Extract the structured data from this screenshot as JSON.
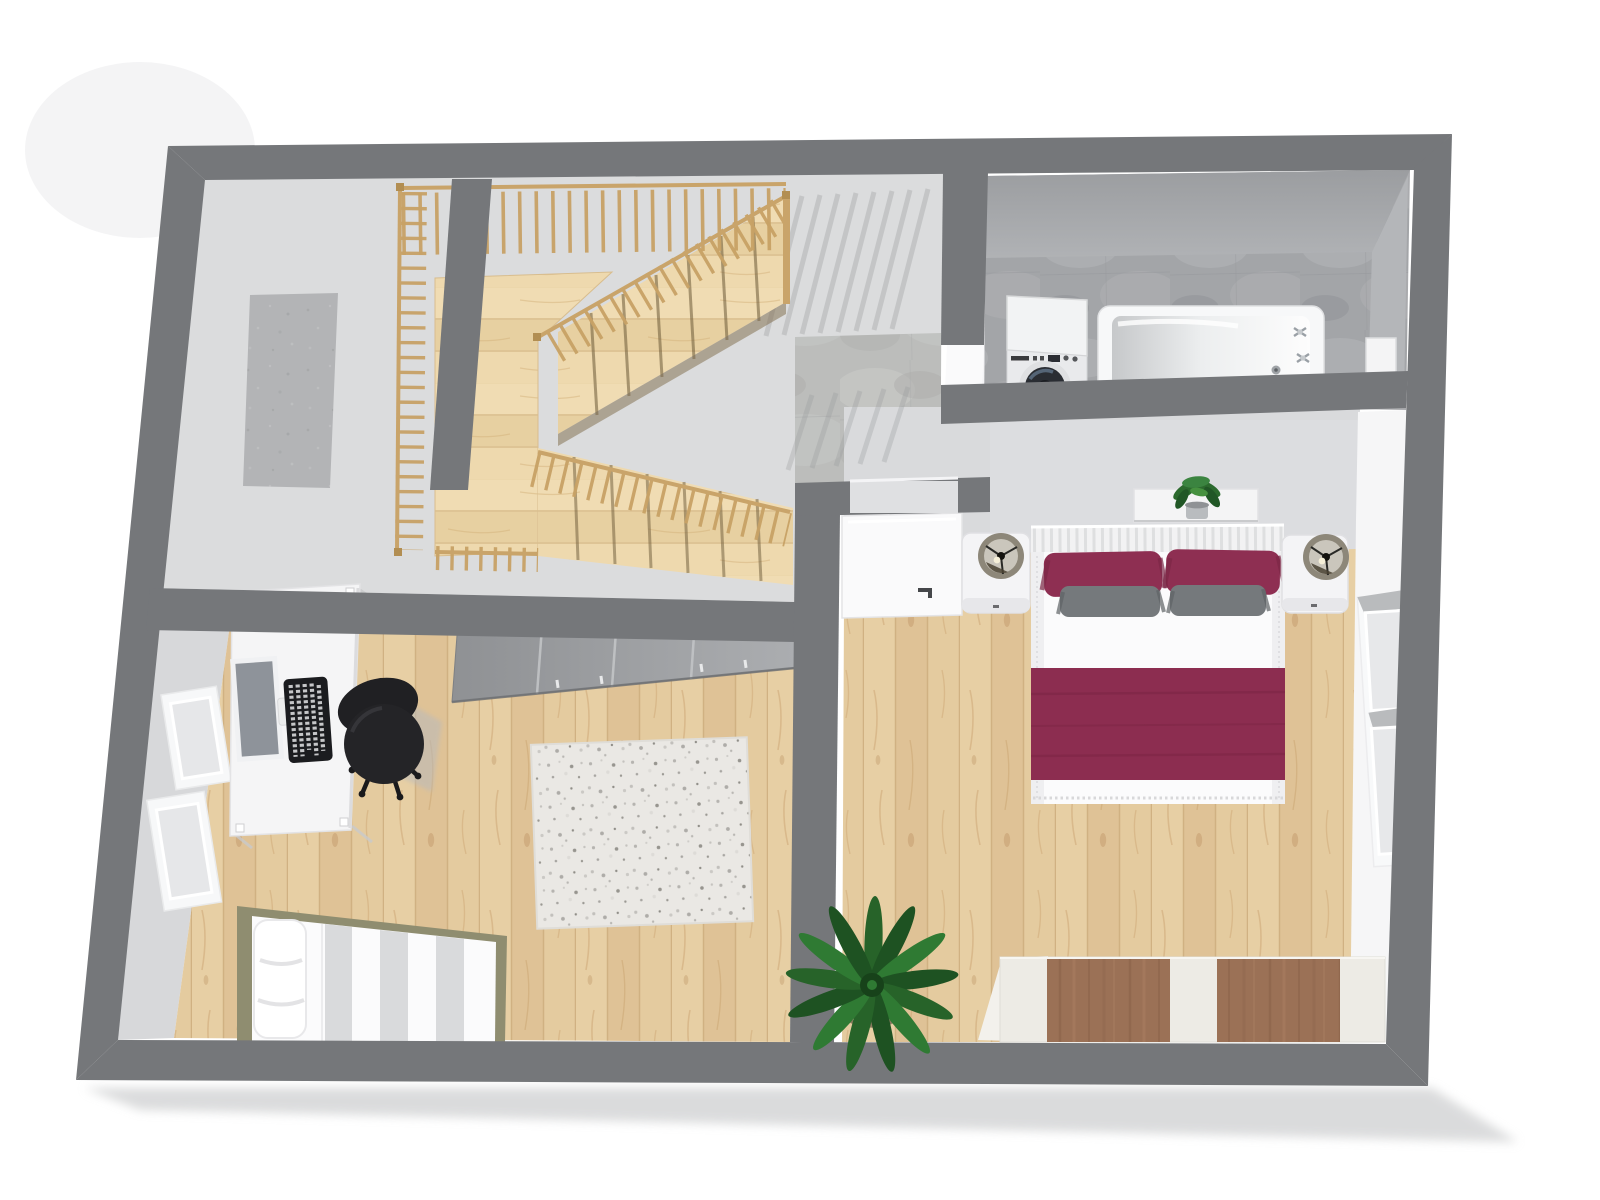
{
  "meta": {
    "image_type": "3d-floor-plan-render",
    "view": "top-down dollhouse perspective",
    "visible_text": ""
  },
  "palette": {
    "wall": "#75777a",
    "wall_face": "#d7d8da",
    "wall_face_light": "#dcdde0",
    "floor_light": "#dbdcdd",
    "corridor": "#b3b4b6",
    "concrete": "#bcbdbb",
    "bath_floor": "#a3a5a8",
    "bath_wall_face": "#a7a9ac",
    "wood": "#e3c99e",
    "stair_wood": "#ead5a9",
    "railing": "#c9a46a",
    "baluster": "#c8a266",
    "white": "#fbfbfc",
    "burgundy": "#8e2f52",
    "blanket": "#8c2d50",
    "pillow_gray": "#75797c",
    "rug": "#eae8e4",
    "wardrobe_gray": "#97999c",
    "wardrobe_brown": "#9b7156",
    "wardrobe_body": "#edebe5",
    "bed_frame_olive": "#8f8d70",
    "plant_green": "#2f7a33",
    "plant_dark": "#1e5222",
    "chair_black": "#202023",
    "lamp_shade": "#8d8779",
    "monitor_screen": "#8e939a",
    "keyboard_black": "#1b1c1f",
    "shadow": "#d2d3d4",
    "stripe_gray": "#d9dadc"
  },
  "scene": {
    "rooms": [
      {
        "name": "staircase-hall",
        "floor": "light-gray",
        "features": [
          "u-shaped-wood-staircase",
          "wood-balustrade",
          "side-corridor",
          "baluster-shadows"
        ]
      },
      {
        "name": "entry-hallway",
        "floor": "concrete-tile",
        "features": [
          "door-to-bedroom",
          "door-to-bathroom"
        ]
      },
      {
        "name": "bathroom",
        "floor": "concrete-tile",
        "fixtures": [
          "washing-machine",
          "bathtub-with-taps",
          "wall-cabinet",
          "white-door"
        ]
      },
      {
        "name": "bedroom",
        "floor": "oak-planks",
        "furniture": [
          "double-bed",
          "slatted-headboard",
          "wall-shelf",
          "small-potted-plant",
          "nightstand-left",
          "nightstand-right",
          "cylinder-lamp-left",
          "cylinder-lamp-right",
          "window-right-wall",
          "built-in-wardrobe-brown-doors",
          "palm-plant",
          "open-white-door"
        ]
      },
      {
        "name": "office",
        "floor": "oak-planks",
        "furniture": [
          "white-desk",
          "monitor",
          "black-keyboard",
          "black-office-chair",
          "gray-sliding-wardrobe",
          "shag-rug",
          "single-bed-striped",
          "window-upper-left",
          "window-lower-left"
        ]
      }
    ],
    "staircase": {
      "type": "u-shaped",
      "flights": 2,
      "landing": true,
      "material": "light-wood",
      "balustrade": "vertical-balusters"
    },
    "bed": {
      "pillows_burgundy": 2,
      "pillows_gray": 2,
      "blanket": "burgundy",
      "duvet": "white"
    }
  }
}
